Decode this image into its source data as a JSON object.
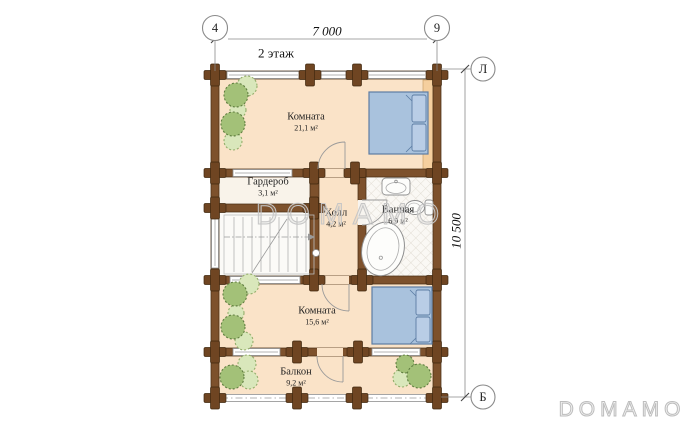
{
  "title": "2 этаж",
  "dimensions": {
    "horizontal": "7 000",
    "vertical": "10 500"
  },
  "axis_markers": {
    "top_left": "4",
    "top_right": "9",
    "right_top": "Л",
    "right_bottom": "Б"
  },
  "rooms": [
    {
      "name": "Комната",
      "area": "21,1 м²"
    },
    {
      "name": "Гардероб",
      "area": "3,1 м²"
    },
    {
      "name": "Холл",
      "area": "4,2 м²"
    },
    {
      "name": "Ванная",
      "area": "6,9 м²"
    },
    {
      "name": "Комната",
      "area": "15,6 м²"
    },
    {
      "name": "Балкон",
      "area": "9,2 м²"
    }
  ],
  "watermarks": {
    "center": "DOMAMO",
    "corner": "DOMAMO"
  },
  "colors": {
    "wall": "#7d512c",
    "wall_outline": "#4a2f15",
    "floor": "#fae3c8",
    "bed": "#a9c2dd",
    "tree_dark": "#a3c178",
    "tree_light": "#d9e7bb",
    "closet_strip": "#f5cf9e"
  }
}
